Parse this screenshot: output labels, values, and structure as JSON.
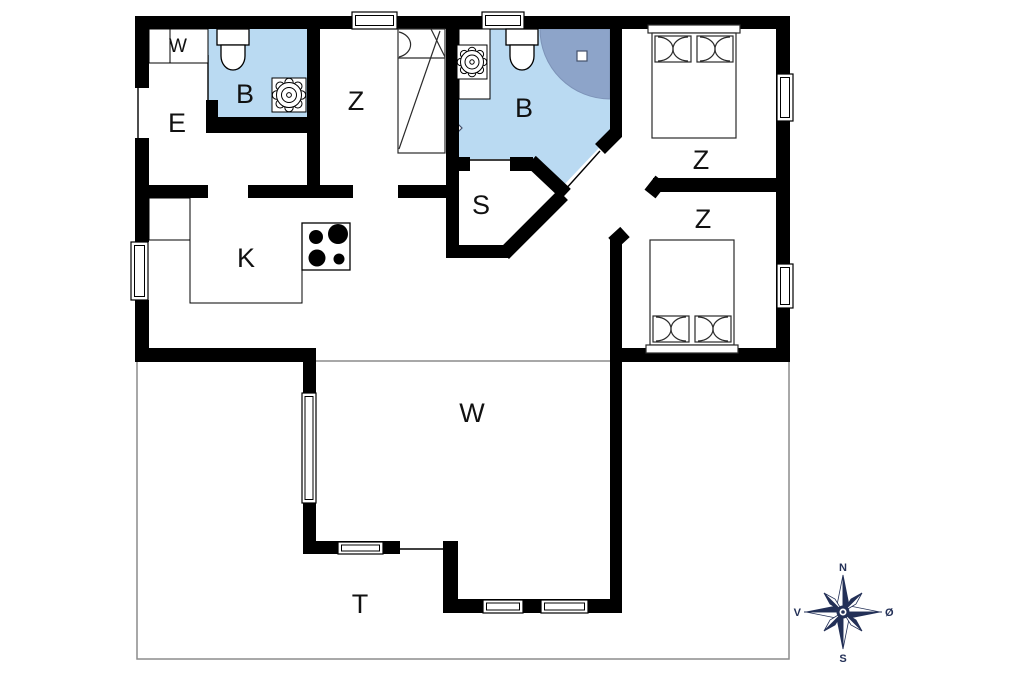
{
  "rooms": {
    "wardrobe": "W",
    "entrance": "E",
    "bath1": "B",
    "bed_mid": "Z",
    "bath2": "B",
    "sauna": "S",
    "bed_right_top": "Z",
    "bed_right_bottom": "Z",
    "kitchen": "K",
    "living": "W",
    "terrace": "T"
  },
  "compass": {
    "n": "N",
    "s": "S",
    "w": "V",
    "e": "Ø"
  },
  "colors": {
    "wall": "#000000",
    "bath_floor": "#badaf2",
    "shower": "#8da4c9",
    "terrace_line": "#8c8c8c",
    "compass": "#233057"
  }
}
